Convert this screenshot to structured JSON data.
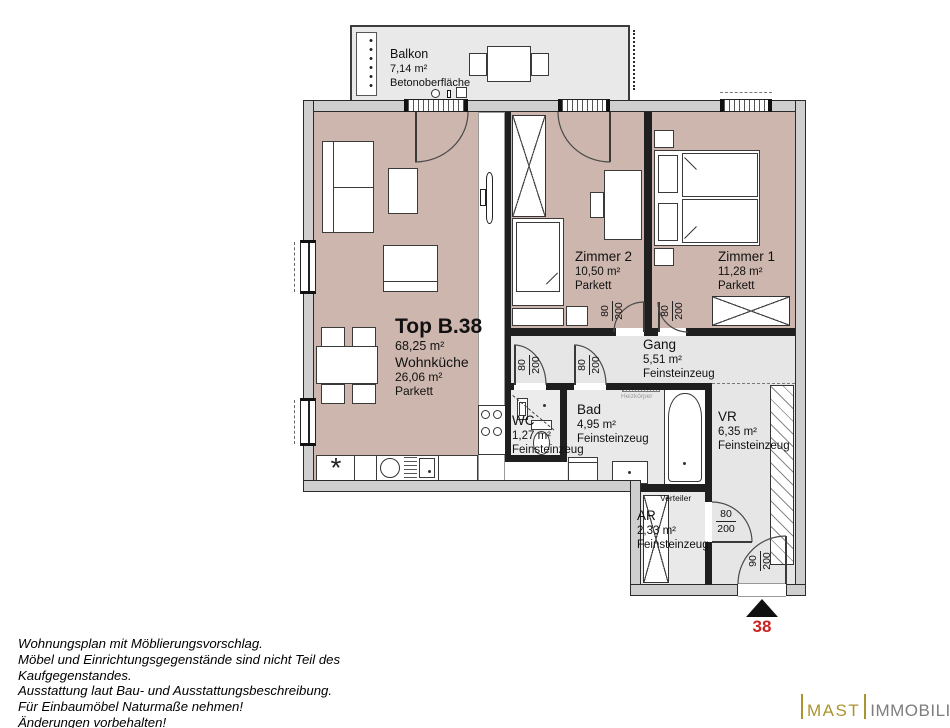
{
  "balcony": {
    "name": "Balkon",
    "area": "7,14 m²",
    "surface": "Betonoberfläche"
  },
  "unit": {
    "id": "Top B.38",
    "total_area": "68,25 m²",
    "kitchen_name": "Wohnküche",
    "kitchen_area": "26,06 m²",
    "kitchen_floor": "Parkett"
  },
  "rooms": {
    "zimmer2": {
      "name": "Zimmer 2",
      "area": "10,50 m²",
      "floor": "Parkett"
    },
    "zimmer1": {
      "name": "Zimmer 1",
      "area": "11,28 m²",
      "floor": "Parkett"
    },
    "gang": {
      "name": "Gang",
      "area": "5,51 m²",
      "floor": "Feinsteinzeug"
    },
    "wc": {
      "name": "WC",
      "area": "1,27 m²",
      "floor": "Feinsteinzeug"
    },
    "bad": {
      "name": "Bad",
      "area": "4,95 m²",
      "floor": "Feinsteinzeug"
    },
    "vr": {
      "name": "VR",
      "area": "6,35 m²",
      "floor": "Feinsteinzeug"
    },
    "ar": {
      "name": "AR",
      "area": "2,33 m²",
      "floor": "Feinsteinzeug"
    }
  },
  "annotations": {
    "radiator": "Heizkörper",
    "distributor": "Verteiler",
    "unit_number": "38"
  },
  "doors": {
    "width_80": "80",
    "width_90": "90",
    "height_200": "200"
  },
  "symbols": {
    "fridge": "*"
  },
  "colors": {
    "room_pink": "#cdb6ae",
    "room_grey": "#e6e6e6",
    "accent_red": "#cc2222",
    "logo_gold": "#ab942f",
    "logo_grey": "#7d7d7d"
  },
  "footer": {
    "lines": [
      "Wohnungsplan mit Möblierungsvorschlag.",
      "Möbel und Einrichtungsgegenstände sind nicht Teil des",
      "Kaufgegenstandes.",
      "Ausstattung laut Bau- und Ausstattungsbeschreibung.",
      "Für Einbaumöbel Naturmaße nehmen!",
      "Änderungen vorbehalten!"
    ]
  },
  "logo": {
    "brand": "MAST",
    "suffix": "IMMOBILIEN"
  }
}
